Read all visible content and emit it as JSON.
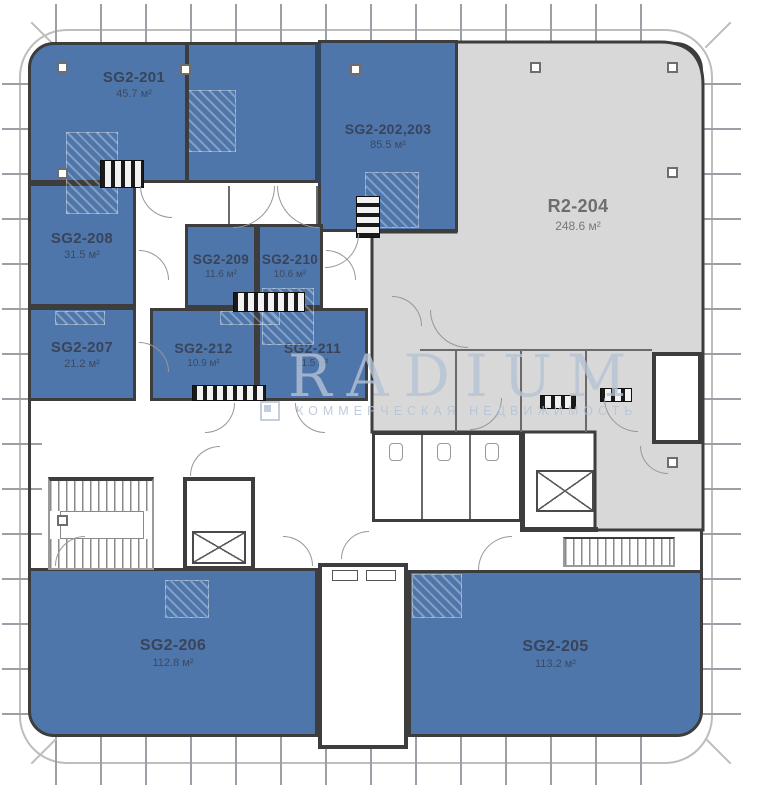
{
  "watermark": {
    "brand": "RADIUM",
    "tagline": "КОММЕРЧЕСКАЯ НЕДВИЖИМОСТЬ"
  },
  "units": [
    {
      "id": "sg2-201",
      "name": "SG2-201",
      "area": "45.7 м²",
      "type": "available"
    },
    {
      "id": "sg2-202-203",
      "name": "SG2-202,203",
      "area": "85.5 м²",
      "type": "available"
    },
    {
      "id": "r2-204",
      "name": "R2-204",
      "area": "248.6 м²",
      "type": "other"
    },
    {
      "id": "sg2-208",
      "name": "SG2-208",
      "area": "31.5 м²",
      "type": "available"
    },
    {
      "id": "sg2-209",
      "name": "SG2-209",
      "area": "11.6 м²",
      "type": "available"
    },
    {
      "id": "sg2-210",
      "name": "SG2-210",
      "area": "10.6 м²",
      "type": "available"
    },
    {
      "id": "sg2-207",
      "name": "SG2-207",
      "area": "21.2 м²",
      "type": "available"
    },
    {
      "id": "sg2-212",
      "name": "SG2-212",
      "area": "10.9 м²",
      "type": "available"
    },
    {
      "id": "sg2-211",
      "name": "SG2-211",
      "area": "11.5 м²",
      "type": "available"
    },
    {
      "id": "sg2-206",
      "name": "SG2-206",
      "area": "112.8 м²",
      "type": "available"
    },
    {
      "id": "sg2-205",
      "name": "SG2-205",
      "area": "113.2 м²",
      "type": "available"
    }
  ],
  "colors": {
    "unit_available": "#4e76aa",
    "unit_other": "#d8d8d8",
    "wall": "#3d3d3d",
    "label_on_blue": "#39445a",
    "label_on_gray": "#6e6e6e",
    "watermark": "#b6c3d5",
    "tick": "#9aa0a6",
    "outline": "#bdbdbd"
  }
}
